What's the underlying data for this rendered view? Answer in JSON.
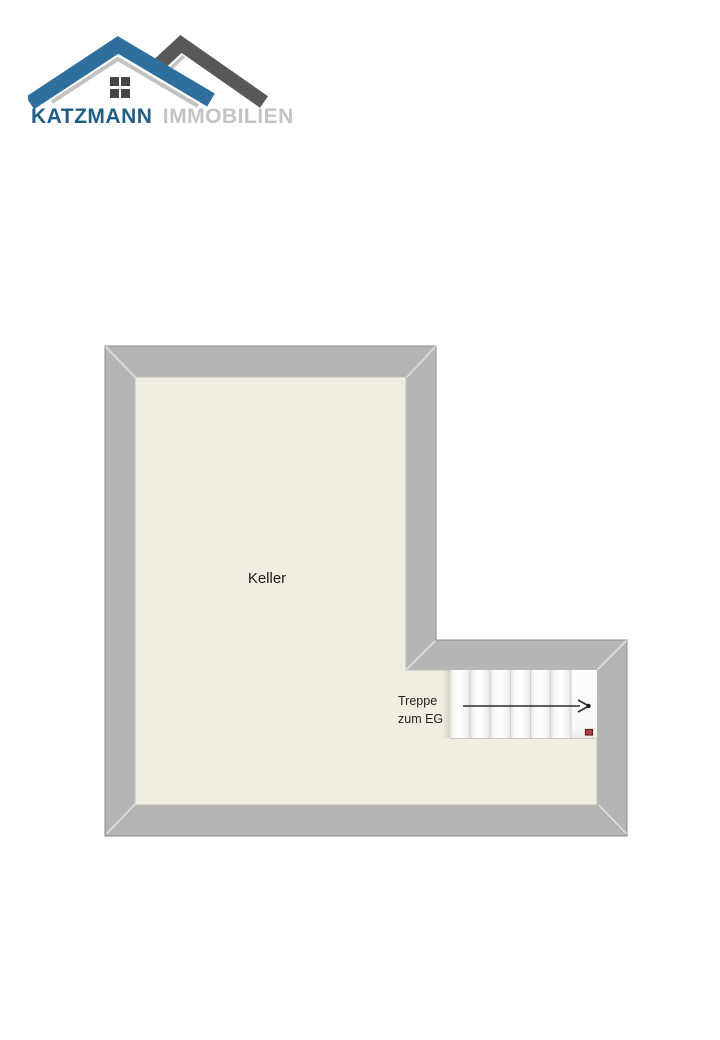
{
  "page": {
    "background": "#ffffff"
  },
  "logo": {
    "brand_primary": "KATZMANN",
    "brand_secondary": "IMMOBILIEN",
    "colors": {
      "roof_blue": "#2f6f9e",
      "roof_dark_gray": "#57585a",
      "roof_silver": "#c2c2c2",
      "window_dark": "#464646",
      "text_primary": "#215e86",
      "text_secondary": "#c3c3c3"
    }
  },
  "floorplan": {
    "room_label": "Keller",
    "stairs_label": {
      "line1": "Treppe",
      "line2": "zum EG"
    },
    "stairs": {
      "tread_count": 7,
      "direction": "right"
    },
    "colors": {
      "wall_fill": "#b5b5b5",
      "wall_outline": "#8d8d8d",
      "floor_fill": "#f1ede3",
      "stair_fill": "#fbfbfb",
      "stair_divider": "#d2d2d2",
      "arrow_color": "#2c2c2c",
      "marker_red": "#b24343",
      "marker_red_border": "#6b1f1f"
    }
  }
}
